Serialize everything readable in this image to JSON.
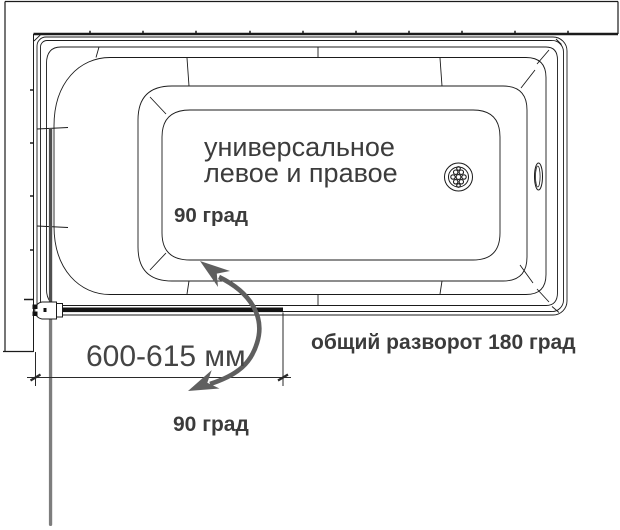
{
  "diagram": {
    "tub_label_line1": "универсальное",
    "tub_label_line2": "левое и правое",
    "angle_top_label": "90 град",
    "dimension_label": "600-615 мм",
    "total_rotation_label": "общий разворот 180 град",
    "angle_bottom_label": "90 град"
  },
  "colors": {
    "line": "#1b1b1b",
    "text": "#3b3b3b",
    "glass_open_segment": "#7d7d7d",
    "glass_inner_segment": "#4f4f4f",
    "door_closed_bar": "#141414",
    "rotation_arrow": "#5f5f5f"
  }
}
